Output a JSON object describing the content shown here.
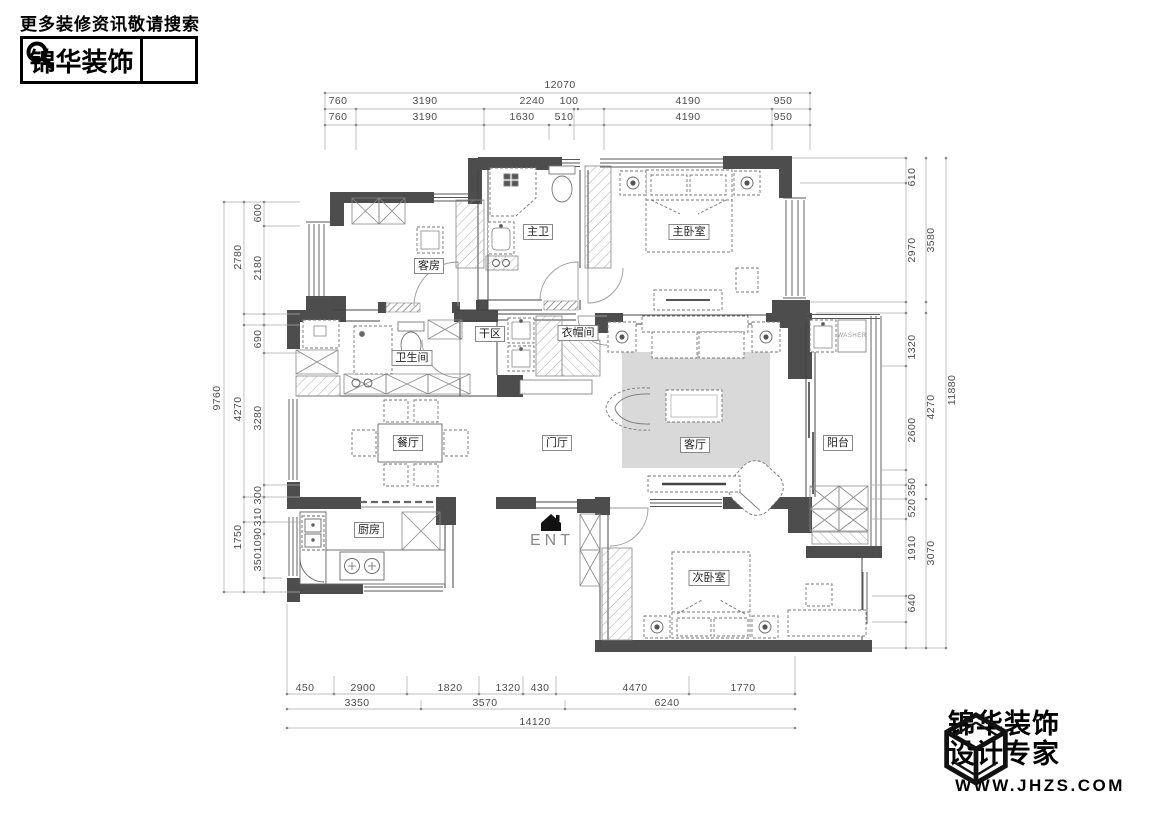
{
  "header": {
    "tagline": "更多装修资讯敬请搜索",
    "brand": "锦华装饰"
  },
  "footer": {
    "brand_top": "锦华装饰",
    "brand_bottom": "设计专家",
    "website": "WWW.JHZS.COM"
  },
  "plan": {
    "rooms": {
      "guest": "客房",
      "master_bath": "主卫",
      "master_bed": "主卧室",
      "dry_area": "干区",
      "bath": "卫生间",
      "cloak": "衣帽间",
      "dining": "餐厅",
      "foyer": "门厅",
      "living": "客厅",
      "balcony": "阳台",
      "kitchen": "厨房",
      "second_bed": "次卧室"
    },
    "entrance": "ENT",
    "washer": "WASHER"
  },
  "dimensions": {
    "top_total": "12070",
    "top_row2": [
      "760",
      "3190",
      "2240",
      "100",
      "4190",
      "950"
    ],
    "top_row3": [
      "760",
      "3190",
      "1630",
      "510",
      "4190",
      "950"
    ],
    "left_total": "9760",
    "left_mid": [
      "2780",
      "4270",
      "1750"
    ],
    "left_inner": [
      "600",
      "2180",
      "690",
      "3280",
      "300",
      "310",
      "1090",
      "350"
    ],
    "right_total": "11880",
    "right_mid": [
      "3580",
      "4270",
      "3070"
    ],
    "right_inner": [
      "610",
      "2970",
      "1320",
      "2600",
      "350",
      "520",
      "1910",
      "640"
    ],
    "bottom_row1": [
      "450",
      "2900",
      "1820",
      "1320",
      "430",
      "4470",
      "1770"
    ],
    "bottom_row2": [
      "3350",
      "3570",
      "6240"
    ],
    "bottom_total": "14120"
  },
  "colors": {
    "wall": "#4d4d4d",
    "rug": "#d9d9d9",
    "dim_text": "#4d4d4d"
  }
}
